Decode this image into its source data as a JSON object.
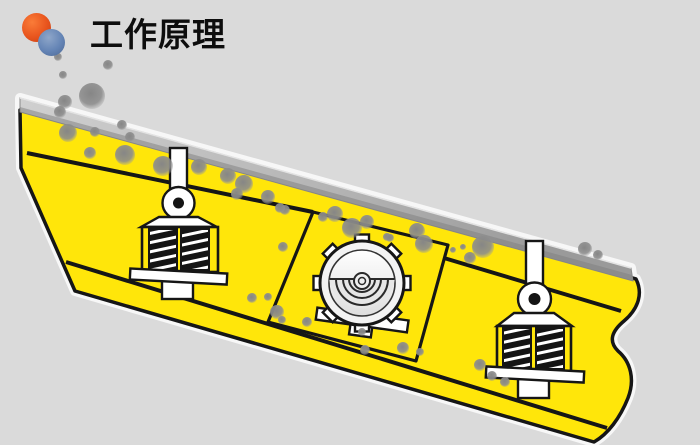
{
  "header": {
    "title": "工作原理"
  },
  "logo": {
    "orange_circle_color": "#e8541d",
    "blue_circle_color": "#6484b5"
  },
  "colors": {
    "background": "#dadada",
    "body_yellow": "#ffe60a",
    "outline": "#161616",
    "part_white": "#ffffff",
    "title_text": "#0d0d0d",
    "rock_gray": "#8d8d8d",
    "deck_light": "#cccccc",
    "deck_dark": "#8f8f8f"
  },
  "diagram": {
    "subject": "vibrating-screen-working-principle",
    "components": [
      "inclined-screen-deck",
      "yellow-screen-box",
      "left-spring-support",
      "right-spring-support",
      "circular-vibration-exciter",
      "material-particles"
    ]
  },
  "rocks": [
    {
      "x": 58,
      "y": 57,
      "r": 4
    },
    {
      "x": 108,
      "y": 65,
      "r": 5
    },
    {
      "x": 63,
      "y": 75,
      "r": 4
    },
    {
      "x": 92,
      "y": 96,
      "r": 13
    },
    {
      "x": 65,
      "y": 102,
      "r": 7
    },
    {
      "x": 60,
      "y": 112,
      "r": 6
    },
    {
      "x": 122,
      "y": 125,
      "r": 5
    },
    {
      "x": 130,
      "y": 137,
      "r": 5
    },
    {
      "x": 68,
      "y": 133,
      "r": 9
    },
    {
      "x": 95,
      "y": 132,
      "r": 5
    },
    {
      "x": 90,
      "y": 153,
      "r": 6
    },
    {
      "x": 125,
      "y": 155,
      "r": 10
    },
    {
      "x": 163,
      "y": 166,
      "r": 10
    },
    {
      "x": 199,
      "y": 167,
      "r": 8
    },
    {
      "x": 228,
      "y": 176,
      "r": 8
    },
    {
      "x": 244,
      "y": 184,
      "r": 9
    },
    {
      "x": 237,
      "y": 194,
      "r": 6
    },
    {
      "x": 268,
      "y": 197,
      "r": 7
    },
    {
      "x": 285,
      "y": 210,
      "r": 5
    },
    {
      "x": 280,
      "y": 208,
      "r": 5
    },
    {
      "x": 283,
      "y": 247,
      "r": 5
    },
    {
      "x": 323,
      "y": 217,
      "r": 5
    },
    {
      "x": 335,
      "y": 214,
      "r": 8
    },
    {
      "x": 352,
      "y": 228,
      "r": 10
    },
    {
      "x": 367,
      "y": 222,
      "r": 7
    },
    {
      "x": 387,
      "y": 237,
      "r": 4
    },
    {
      "x": 417,
      "y": 231,
      "r": 8
    },
    {
      "x": 424,
      "y": 244,
      "r": 9
    },
    {
      "x": 390,
      "y": 238,
      "r": 4
    },
    {
      "x": 453,
      "y": 250,
      "r": 3
    },
    {
      "x": 463,
      "y": 247,
      "r": 3
    },
    {
      "x": 483,
      "y": 247,
      "r": 11
    },
    {
      "x": 470,
      "y": 258,
      "r": 6
    },
    {
      "x": 585,
      "y": 249,
      "r": 7
    },
    {
      "x": 598,
      "y": 255,
      "r": 5
    },
    {
      "x": 252,
      "y": 298,
      "r": 5
    },
    {
      "x": 268,
      "y": 297,
      "r": 4
    },
    {
      "x": 277,
      "y": 312,
      "r": 7
    },
    {
      "x": 282,
      "y": 320,
      "r": 4
    },
    {
      "x": 307,
      "y": 322,
      "r": 5
    },
    {
      "x": 362,
      "y": 332,
      "r": 4
    },
    {
      "x": 365,
      "y": 350,
      "r": 5
    },
    {
      "x": 403,
      "y": 348,
      "r": 6
    },
    {
      "x": 420,
      "y": 352,
      "r": 4
    },
    {
      "x": 480,
      "y": 365,
      "r": 6
    },
    {
      "x": 492,
      "y": 376,
      "r": 5
    },
    {
      "x": 505,
      "y": 382,
      "r": 5
    }
  ]
}
